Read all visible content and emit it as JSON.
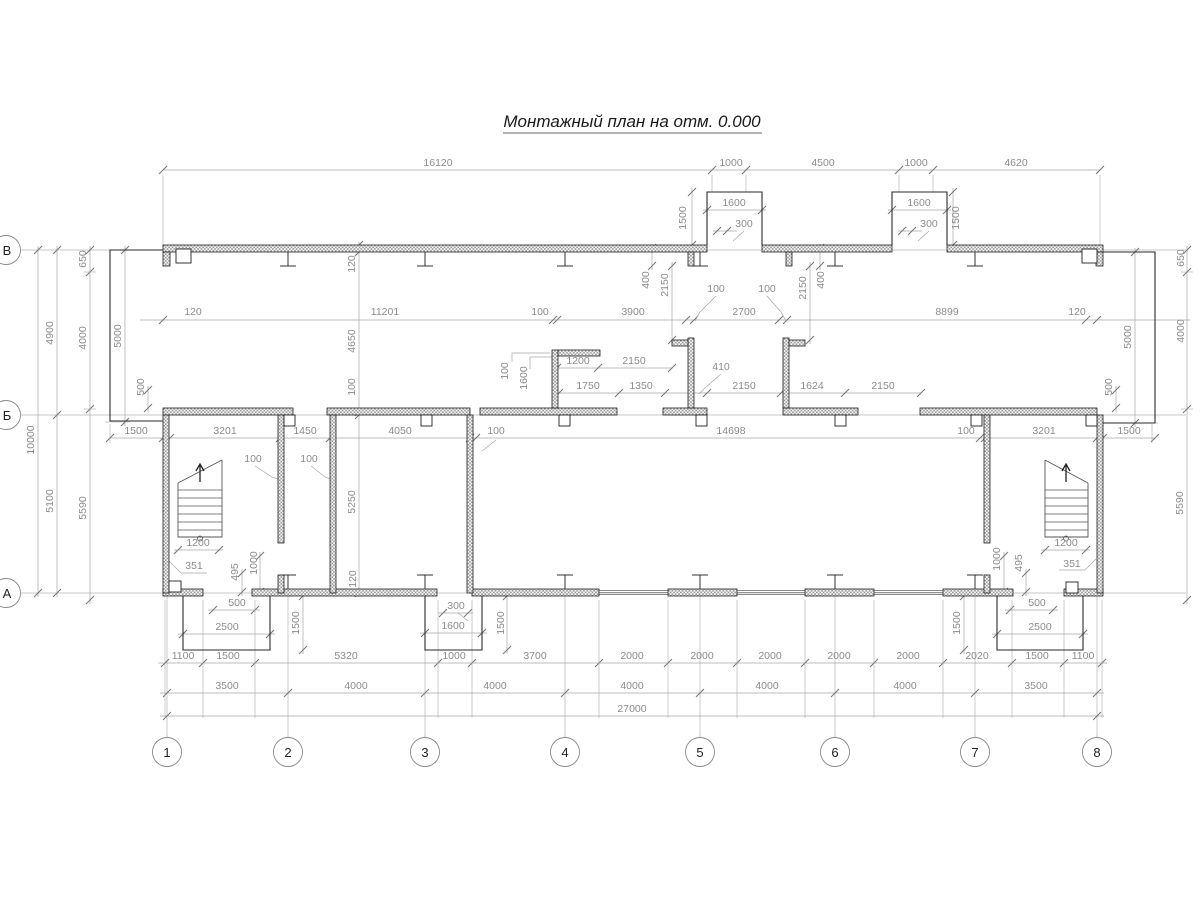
{
  "title": {
    "text": "Монтажный план на отм. 0.000"
  },
  "colors": {
    "wall_line": "#1f1f1f",
    "wall_hatch": "#9a9a9a",
    "dim_text": "#8c8c8c",
    "dim_line": "#a6a6a6",
    "tick": "#777777",
    "axis_line": "#b5b5b5",
    "outline": "#2a2a2a",
    "stair_line": "#555555",
    "background": "#ffffff"
  },
  "axes": {
    "columns": [
      {
        "label": "1",
        "x": 167
      },
      {
        "label": "2",
        "x": 288
      },
      {
        "label": "3",
        "x": 425
      },
      {
        "label": "4",
        "x": 565
      },
      {
        "label": "5",
        "x": 700
      },
      {
        "label": "6",
        "x": 835
      },
      {
        "label": "7",
        "x": 975
      },
      {
        "label": "8",
        "x": 1097
      }
    ],
    "rows": [
      {
        "label": "В",
        "y": 250
      },
      {
        "label": "Б",
        "y": 415
      },
      {
        "label": "А",
        "y": 593
      }
    ]
  },
  "dim_labels": [
    {
      "t": "16120",
      "x": 438,
      "y": 166
    },
    {
      "t": "1000",
      "x": 731,
      "y": 166
    },
    {
      "t": "4500",
      "x": 823,
      "y": 166
    },
    {
      "t": "1000",
      "x": 916,
      "y": 166
    },
    {
      "t": "4620",
      "x": 1016,
      "y": 166
    },
    {
      "t": "1600",
      "x": 734,
      "y": 206
    },
    {
      "t": "300",
      "x": 744,
      "y": 227
    },
    {
      "t": "1600",
      "x": 919,
      "y": 206
    },
    {
      "t": "300",
      "x": 929,
      "y": 227
    },
    {
      "t": "1500",
      "x": 686,
      "y": 218,
      "r": -90
    },
    {
      "t": "1500",
      "x": 959,
      "y": 218,
      "r": -90
    },
    {
      "t": "120",
      "x": 193,
      "y": 315
    },
    {
      "t": "11201",
      "x": 385,
      "y": 315
    },
    {
      "t": "100",
      "x": 540,
      "y": 315
    },
    {
      "t": "3900",
      "x": 633,
      "y": 315
    },
    {
      "t": "2700",
      "x": 744,
      "y": 315
    },
    {
      "t": "8899",
      "x": 947,
      "y": 315
    },
    {
      "t": "120",
      "x": 1077,
      "y": 315
    },
    {
      "t": "100",
      "x": 716,
      "y": 292
    },
    {
      "t": "100",
      "x": 767,
      "y": 292
    },
    {
      "t": "400",
      "x": 649,
      "y": 280,
      "r": -90
    },
    {
      "t": "2150",
      "x": 668,
      "y": 285,
      "r": -90
    },
    {
      "t": "2150",
      "x": 806,
      "y": 288,
      "r": -90
    },
    {
      "t": "400",
      "x": 824,
      "y": 280,
      "r": -90
    },
    {
      "t": "120",
      "x": 355,
      "y": 264,
      "r": -90
    },
    {
      "t": "4650",
      "x": 355,
      "y": 341,
      "r": -90
    },
    {
      "t": "100",
      "x": 355,
      "y": 387,
      "r": -90
    },
    {
      "t": "100",
      "x": 508,
      "y": 371,
      "r": -90
    },
    {
      "t": "1600",
      "x": 527,
      "y": 378,
      "r": -90
    },
    {
      "t": "1200",
      "x": 578,
      "y": 364
    },
    {
      "t": "2150",
      "x": 634,
      "y": 364
    },
    {
      "t": "1750",
      "x": 588,
      "y": 389
    },
    {
      "t": "1350",
      "x": 641,
      "y": 389
    },
    {
      "t": "410",
      "x": 721,
      "y": 370
    },
    {
      "t": "2150",
      "x": 744,
      "y": 389
    },
    {
      "t": "1624",
      "x": 812,
      "y": 389
    },
    {
      "t": "2150",
      "x": 883,
      "y": 389
    },
    {
      "t": "10000",
      "x": 34,
      "y": 440,
      "r": -90
    },
    {
      "t": "4900",
      "x": 53,
      "y": 333,
      "r": -90
    },
    {
      "t": "5100",
      "x": 53,
      "y": 501,
      "r": -90
    },
    {
      "t": "650",
      "x": 86,
      "y": 259,
      "r": -90
    },
    {
      "t": "4000",
      "x": 86,
      "y": 338,
      "r": -90
    },
    {
      "t": "5590",
      "x": 86,
      "y": 508,
      "r": -90
    },
    {
      "t": "5000",
      "x": 121,
      "y": 336,
      "r": -90
    },
    {
      "t": "500",
      "x": 144,
      "y": 387,
      "r": -90
    },
    {
      "t": "650",
      "x": 1184,
      "y": 258,
      "r": -90
    },
    {
      "t": "4000",
      "x": 1184,
      "y": 331,
      "r": -90
    },
    {
      "t": "5000",
      "x": 1131,
      "y": 337,
      "r": -90
    },
    {
      "t": "500",
      "x": 1112,
      "y": 387,
      "r": -90
    },
    {
      "t": "5590",
      "x": 1183,
      "y": 503,
      "r": -90
    },
    {
      "t": "1500",
      "x": 136,
      "y": 434
    },
    {
      "t": "3201",
      "x": 225,
      "y": 434
    },
    {
      "t": "1450",
      "x": 305,
      "y": 434
    },
    {
      "t": "4050",
      "x": 400,
      "y": 434
    },
    {
      "t": "100",
      "x": 496,
      "y": 434
    },
    {
      "t": "14698",
      "x": 731,
      "y": 434
    },
    {
      "t": "100",
      "x": 966,
      "y": 434
    },
    {
      "t": "3201",
      "x": 1044,
      "y": 434
    },
    {
      "t": "1500",
      "x": 1129,
      "y": 434
    },
    {
      "t": "100",
      "x": 253,
      "y": 462
    },
    {
      "t": "100",
      "x": 309,
      "y": 462
    },
    {
      "t": "1200",
      "x": 198,
      "y": 546
    },
    {
      "t": "351",
      "x": 194,
      "y": 569
    },
    {
      "t": "495",
      "x": 238,
      "y": 572,
      "r": -90
    },
    {
      "t": "1000",
      "x": 257,
      "y": 563,
      "r": -90
    },
    {
      "t": "5250",
      "x": 355,
      "y": 502,
      "r": -90
    },
    {
      "t": "120",
      "x": 356,
      "y": 579,
      "r": -90
    },
    {
      "t": "1200",
      "x": 1066,
      "y": 546
    },
    {
      "t": "351",
      "x": 1072,
      "y": 567
    },
    {
      "t": "1000",
      "x": 1000,
      "y": 559,
      "r": -90
    },
    {
      "t": "495",
      "x": 1022,
      "y": 563,
      "r": -90
    },
    {
      "t": "500",
      "x": 237,
      "y": 606
    },
    {
      "t": "2500",
      "x": 227,
      "y": 630
    },
    {
      "t": "1500",
      "x": 299,
      "y": 623,
      "r": -90
    },
    {
      "t": "300",
      "x": 456,
      "y": 609
    },
    {
      "t": "1600",
      "x": 453,
      "y": 629
    },
    {
      "t": "1500",
      "x": 504,
      "y": 623,
      "r": -90
    },
    {
      "t": "500",
      "x": 1037,
      "y": 606
    },
    {
      "t": "2500",
      "x": 1040,
      "y": 630
    },
    {
      "t": "1500",
      "x": 960,
      "y": 623,
      "r": -90
    },
    {
      "t": "1100",
      "x": 183,
      "y": 659
    },
    {
      "t": "1500",
      "x": 228,
      "y": 659
    },
    {
      "t": "5320",
      "x": 346,
      "y": 659
    },
    {
      "t": "1000",
      "x": 454,
      "y": 659
    },
    {
      "t": "3700",
      "x": 535,
      "y": 659
    },
    {
      "t": "2000",
      "x": 632,
      "y": 659
    },
    {
      "t": "2000",
      "x": 702,
      "y": 659
    },
    {
      "t": "2000",
      "x": 770,
      "y": 659
    },
    {
      "t": "2000",
      "x": 839,
      "y": 659
    },
    {
      "t": "2000",
      "x": 908,
      "y": 659
    },
    {
      "t": "2020",
      "x": 977,
      "y": 659
    },
    {
      "t": "1500",
      "x": 1037,
      "y": 659
    },
    {
      "t": "1100",
      "x": 1083,
      "y": 659
    },
    {
      "t": "3500",
      "x": 227,
      "y": 689
    },
    {
      "t": "4000",
      "x": 356,
      "y": 689
    },
    {
      "t": "4000",
      "x": 495,
      "y": 689
    },
    {
      "t": "4000",
      "x": 632,
      "y": 689
    },
    {
      "t": "4000",
      "x": 767,
      "y": 689
    },
    {
      "t": "4000",
      "x": 905,
      "y": 689
    },
    {
      "t": "3500",
      "x": 1036,
      "y": 689
    },
    {
      "t": "27000",
      "x": 632,
      "y": 712
    }
  ]
}
